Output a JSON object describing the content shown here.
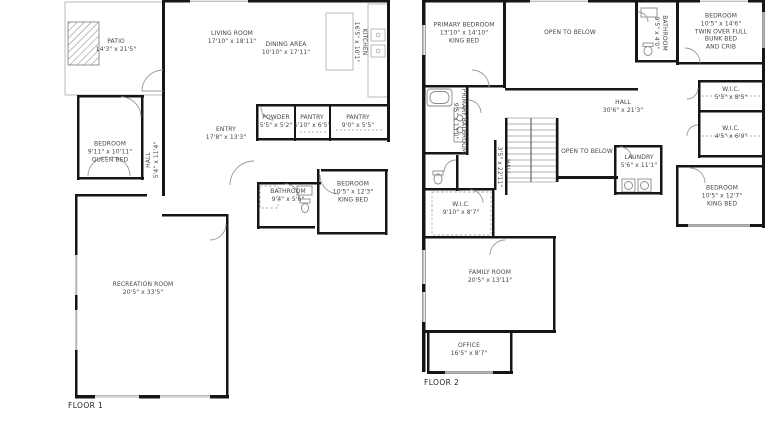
{
  "palette": {
    "background": "#ffffff",
    "wall": "#161616",
    "thin_line": "#a8a8a8",
    "text": "#454545"
  },
  "floor1": {
    "label": "FLOOR 1",
    "rooms": {
      "patio": {
        "name": "PATIO",
        "dims": "14'3\" x 21'5\""
      },
      "living": {
        "name": "LIVING ROOM",
        "dims": "17'10\" x 18'11\""
      },
      "dining": {
        "name": "DINING AREA",
        "dims": "10'10\" x 17'11\""
      },
      "kitchen": {
        "name": "KITCHEN",
        "dims": "16'5\" x 10'1\""
      },
      "entry": {
        "name": "ENTRY",
        "dims": "17'8\" x 13'3\""
      },
      "powder": {
        "name": "POWDER",
        "dims": "5'5\" x 5'2\""
      },
      "pantry1": {
        "name": "PANTRY",
        "dims": "5'10\" x 6'5\""
      },
      "pantry2": {
        "name": "PANTRY",
        "dims": "9'0\" x 5'5\""
      },
      "bedroom1": {
        "name": "BEDROOM",
        "dims": "9'11\" x 10'11\"",
        "extra": "QUEEN BED"
      },
      "hall": {
        "name": "HALL",
        "dims": "5'4\" x 11'4\""
      },
      "bathroom": {
        "name": "BATHROOM",
        "dims": "9'4\" x 5'6\""
      },
      "bedroom2": {
        "name": "BEDROOM",
        "dims": "10'5\" x 12'3\"",
        "extra": "KING BED"
      },
      "recreation": {
        "name": "RECREATION ROOM",
        "dims": "20'5\" x 33'5\""
      }
    }
  },
  "floor2": {
    "label": "FLOOR 2",
    "rooms": {
      "primary": {
        "name": "PRIMARY BEDROOM",
        "dims": "13'10\" x 14'10\"",
        "extra": "KING BED"
      },
      "open1": {
        "name": "OPEN TO BELOW"
      },
      "bath2": {
        "name": "BATHROOM",
        "dims": "9'5\" x 4'0\""
      },
      "bedroom3": {
        "name": "BEDROOM",
        "dims": "10'5\" x 14'6\"",
        "extra": "TWIN OVER FULL",
        "extra2": "BUNK BED",
        "extra3": "AND CRIB"
      },
      "wic1": {
        "name": "W.I.C.",
        "dims": "5'5\" x 8'5\""
      },
      "wic2": {
        "name": "W.I.C.",
        "dims": "4'5\" x 6'0\""
      },
      "hall": {
        "name": "HALL",
        "dims": "30'6\" x 21'3\""
      },
      "open2": {
        "name": "OPEN TO BELOW"
      },
      "laundry": {
        "name": "LAUNDRY",
        "dims": "5'6\" x 11'1\""
      },
      "bedroom4": {
        "name": "BEDROOM",
        "dims": "10'5\" x 12'7\"",
        "extra": "KING BED"
      },
      "pbath": {
        "name": "PRIMARY BATHROOM",
        "dims": "9'5\" x 13'0\""
      },
      "hall2": {
        "name": "HALL",
        "dims": "3'5\" x 22'11\""
      },
      "wic3": {
        "name": "W.I.C.",
        "dims": "9'10\" x 8'7\""
      },
      "family": {
        "name": "FAMILY ROOM",
        "dims": "20'5\" x 13'11\""
      },
      "office": {
        "name": "OFFICE",
        "dims": "16'5\" x 8'7\""
      }
    }
  }
}
